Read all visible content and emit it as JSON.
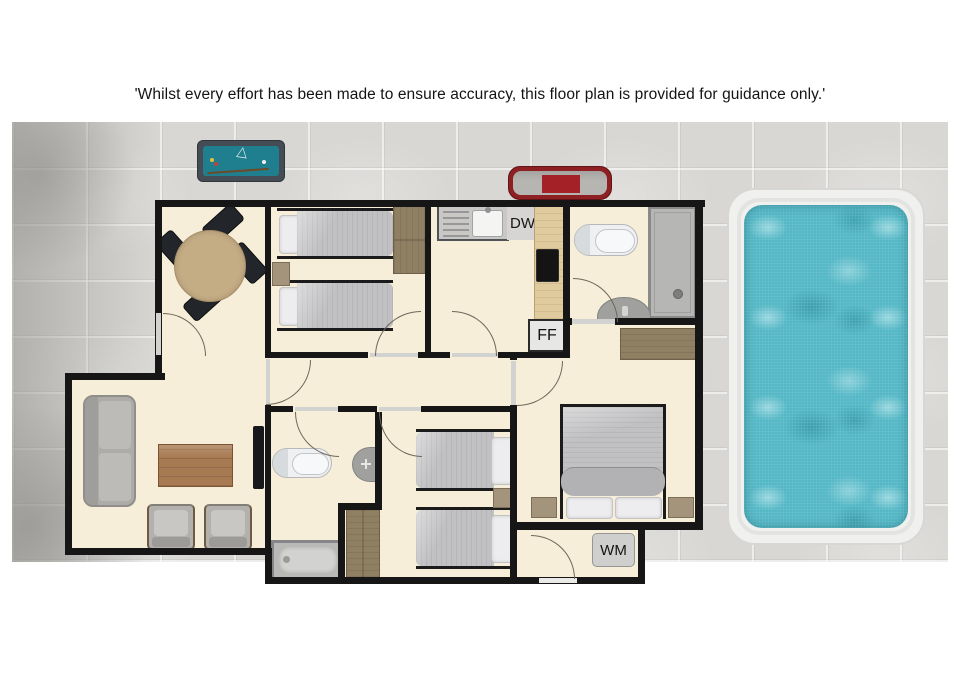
{
  "disclaimer": "'Whilst every effort has been made to ensure accuracy, this floor plan is provided for guidance only.'",
  "labels": {
    "dw": "DW",
    "ff": "FF",
    "wm": "WM"
  },
  "colors": {
    "wall": "#161616",
    "floor": "#f6eed9",
    "patio_tile": "#d8d7d4",
    "pool_water": "#53b7c5",
    "pool_surround": "#f0f0ee",
    "pool_table_felt": "#1f7f8f",
    "bbq_red": "#8e2024",
    "wood_dark": "#8f7f63",
    "counter_wood": "#e0cb9f",
    "upholstery_gray": "#b3b1ae",
    "bedding_gray": "#c1c1c3",
    "coffee_table_wood": "#a87a52"
  },
  "rooms": [
    "dining-room",
    "twin-bedroom-1",
    "kitchen",
    "shower-room",
    "living-room",
    "hallway",
    "bathroom",
    "twin-bedroom-2",
    "master-bedroom",
    "utility-room"
  ],
  "outdoor": [
    "patio",
    "pool-table",
    "bbq",
    "swimming-pool"
  ]
}
